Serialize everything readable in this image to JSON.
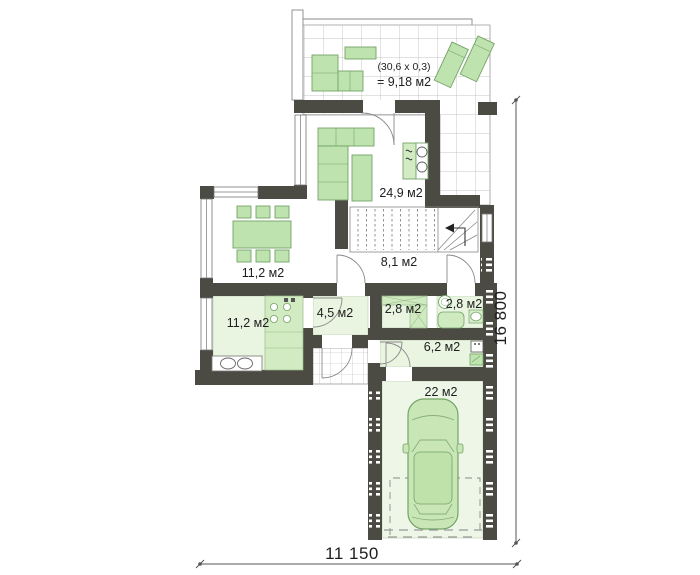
{
  "plan": {
    "title": "ground-floor-plan",
    "rooms": [
      {
        "name": "terrace",
        "note": "(30,6 x 0,3)",
        "area": "= 9,18 м2"
      },
      {
        "name": "living-room",
        "area": "24,9 м2"
      },
      {
        "name": "stair-hall",
        "area": "8,1 м2"
      },
      {
        "name": "dining-room",
        "area": "11,2 м2"
      },
      {
        "name": "kitchen",
        "area": "11,2 м2"
      },
      {
        "name": "corridor",
        "area": "4,5 м2"
      },
      {
        "name": "closet",
        "area": "2,8 м2"
      },
      {
        "name": "bathroom",
        "area": "2,8 м2"
      },
      {
        "name": "mudroom",
        "area": "6,2 м2"
      },
      {
        "name": "garage",
        "area": "22 м2"
      }
    ],
    "dimensions": {
      "width": "11 150",
      "height": "16 800"
    },
    "colors": {
      "wall": "#4b4b43",
      "furniture_fill": "#bfe3ae",
      "furniture_stroke": "#74a368",
      "floor_pale": "#e9f4e1",
      "counter_green": "#d2ebc2",
      "tile_line": "#b3b3b3",
      "text": "#1e1e1e"
    }
  }
}
